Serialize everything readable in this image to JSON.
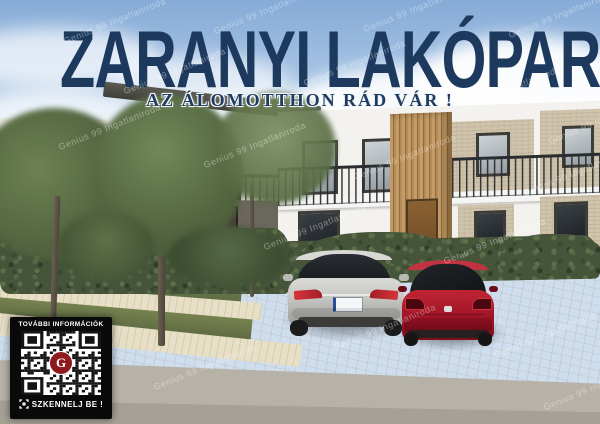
{
  "poster": {
    "title": "ZARANYI LAKÓPARK",
    "subtitle": "AZ ÁLOMOTTHON RÁD VÁR !"
  },
  "watermark": {
    "text": "Genius 99 Ingatlaniroda"
  },
  "qr_panel": {
    "header": "TOVÁBBI INFORMÁCIÓK",
    "footer": "SZKENNELJ BE !",
    "logo_letter": "G"
  },
  "icons": {
    "scan": "scan-icon",
    "qr_logo": "brand-g-logo"
  },
  "colors": {
    "title_navy": "#1d3a5e",
    "qr_logo_red": "#8e1a1f",
    "wood_accent": "#b48c58",
    "car_silver": "#c7c7c4",
    "car_red": "#a5172a",
    "hedge_green": "#46543a",
    "pavement_beige": "#d8ceb5"
  }
}
